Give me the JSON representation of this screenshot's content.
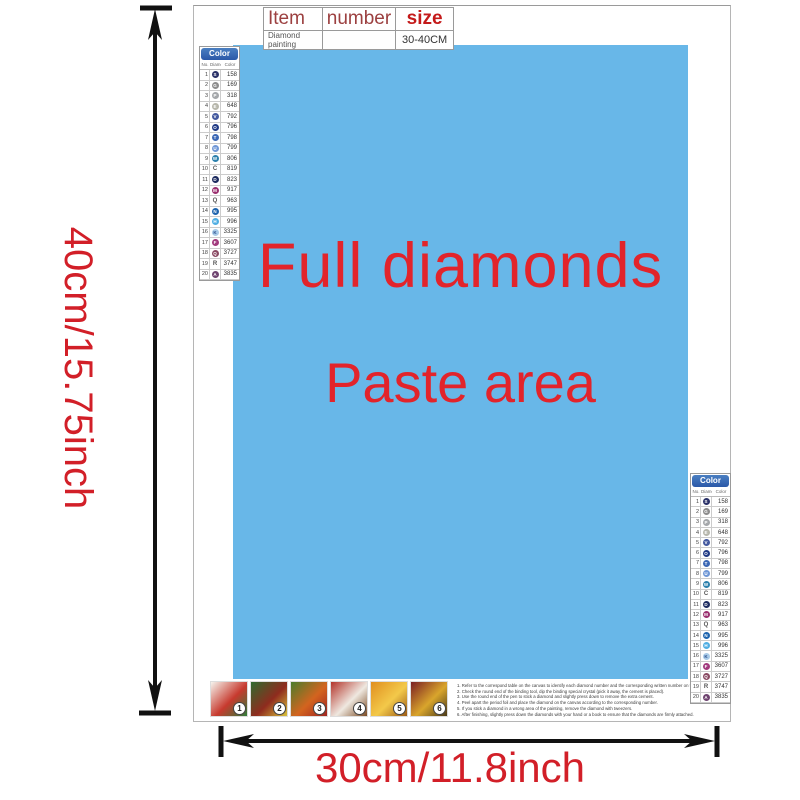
{
  "item_table": {
    "headers": {
      "item": "Item",
      "number": "number",
      "size": "size"
    },
    "row": {
      "item": "Diamond painting",
      "number": "",
      "size": "30-40CM"
    }
  },
  "paste_area": {
    "line1": "Full diamonds",
    "line2": "Paste area"
  },
  "dimensions": {
    "height_label": "40cm/15.75inch",
    "width_label": "30cm/11.8inch"
  },
  "color_list": {
    "title": "Color List",
    "columns": [
      "No.",
      "Diamond",
      "Color"
    ],
    "rows": [
      {
        "no": "1",
        "symbol": "S",
        "code": "158",
        "fill": "#2A3168",
        "glyph_color": "#FFFFFF"
      },
      {
        "no": "2",
        "symbol": "G",
        "code": "169",
        "fill": "#8C8C8C",
        "glyph_color": "#FFFFFF"
      },
      {
        "no": "3",
        "symbol": "P",
        "code": "318",
        "fill": "#A4A7AA",
        "glyph_color": "#FFFFFF"
      },
      {
        "no": "4",
        "symbol": "E",
        "code": "648",
        "fill": "#B6B6AB",
        "glyph_color": "#FFFFFF"
      },
      {
        "no": "5",
        "symbol": "V",
        "code": "792",
        "fill": "#44599F",
        "glyph_color": "#FFFFFF"
      },
      {
        "no": "6",
        "symbol": "O",
        "code": "796",
        "fill": "#203A85",
        "glyph_color": "#FFFFFF"
      },
      {
        "no": "7",
        "symbol": "T",
        "code": "798",
        "fill": "#3B67B5",
        "glyph_color": "#FFFFFF"
      },
      {
        "no": "8",
        "symbol": "U",
        "code": "799",
        "fill": "#6F97D6",
        "glyph_color": "#FFFFFF"
      },
      {
        "no": "9",
        "symbol": "W",
        "code": "806",
        "fill": "#2B80AC",
        "glyph_color": "#FFFFFF"
      },
      {
        "no": "10",
        "symbol": "C",
        "code": "819",
        "fill": null,
        "glyph_color": "#555555"
      },
      {
        "no": "11",
        "symbol": "D",
        "code": "823",
        "fill": "#1D2B5F",
        "glyph_color": "#FFFFFF"
      },
      {
        "no": "12",
        "symbol": "M",
        "code": "917",
        "fill": "#9A2F6F",
        "glyph_color": "#FFFFFF"
      },
      {
        "no": "13",
        "symbol": "Q",
        "code": "963",
        "fill": null,
        "glyph_color": "#555555"
      },
      {
        "no": "14",
        "symbol": "N",
        "code": "995",
        "fill": "#1E64AE",
        "glyph_color": "#FFFFFF"
      },
      {
        "no": "15",
        "symbol": "H",
        "code": "996",
        "fill": "#4FAEE3",
        "glyph_color": "#FFFFFF"
      },
      {
        "no": "16",
        "symbol": "K",
        "code": "3325",
        "fill": "#A9CBE8",
        "glyph_color": "#2B4E8C"
      },
      {
        "no": "17",
        "symbol": "F",
        "code": "3607",
        "fill": "#A23A7D",
        "glyph_color": "#FFFFFF"
      },
      {
        "no": "18",
        "symbol": "Q",
        "code": "3727",
        "fill": "#8A4A63",
        "glyph_color": "#FFFFFF"
      },
      {
        "no": "19",
        "symbol": "R",
        "code": "3747",
        "fill": null,
        "glyph_color": "#555555"
      },
      {
        "no": "20",
        "symbol": "A",
        "code": "3835",
        "fill": "#6F4470",
        "glyph_color": "#FFFFFF"
      }
    ]
  },
  "steps": [
    {
      "number": "1",
      "colors": [
        "#f5f4ee",
        "#c73a2e",
        "#2f7d3a"
      ]
    },
    {
      "number": "2",
      "colors": [
        "#2e6b2f",
        "#8f2b1e",
        "#d8c23a"
      ]
    },
    {
      "number": "3",
      "colors": [
        "#4a7d2c",
        "#d3641f",
        "#a02420"
      ]
    },
    {
      "number": "4",
      "colors": [
        "#b3342a",
        "#efe8e0",
        "#7a4a22"
      ]
    },
    {
      "number": "5",
      "colors": [
        "#e08f1f",
        "#f3c94a",
        "#9c5a14"
      ]
    },
    {
      "number": "6",
      "colors": [
        "#7a1f24",
        "#d9a52c",
        "#4a3a18"
      ]
    }
  ],
  "instructions": [
    "1. Refer to the correspond table on the canvas to identify each diamond number and the corresponding written number on the canvas.",
    "2. Check the round end of the binding tool, dip the binding special crystal (pick it away, the cement is placed).",
    "3. Use the round end of the pen to stick a diamond and slightly press down to remove the extra cement.",
    "4. Peel apart the period foil and place the diamond on the canvas according to the corresponding number.",
    "5. If you stick a diamond in a wrong area of the painting, remove the diamond with tweezers.",
    "6. After finishing, slightly press down the diamonds with your hand or a book to ensure that the diamonds are firmly attached."
  ],
  "colors": {
    "paste_area_blue": "#68B7E8",
    "paste_text_red": "#E2242B",
    "dimension_red": "#D21F28",
    "header_dark_red": "#9C4040",
    "size_red": "#C41A1A",
    "arrow_black": "#111111"
  }
}
